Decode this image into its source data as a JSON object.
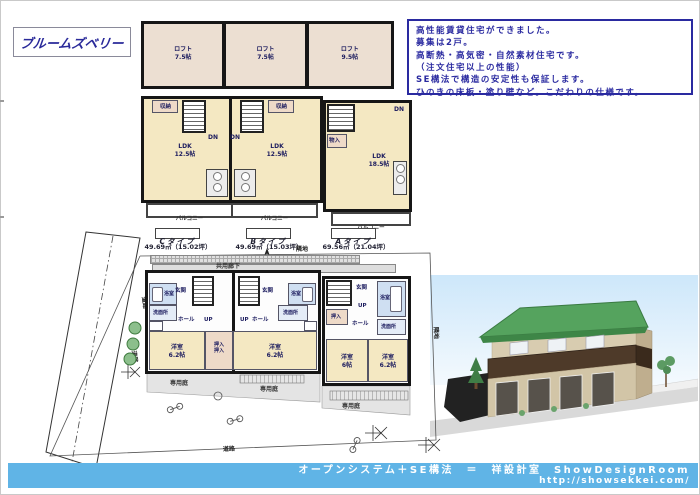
{
  "title": "ブルームズベリー",
  "info_box": {
    "lines": [
      "高性能賃貸住宅ができました。",
      "募集は2戸。",
      "高断熱・高気密・自然素材住宅です。",
      "（注文住宅以上の性能）",
      "SE構法で構造の安定性も保証します。",
      "ひのきの床板・塗り壁など。こだわりの仕様です。"
    ]
  },
  "loft_plan": {
    "room_label": "ロフト",
    "sizes": [
      "7.5帖",
      "7.5帖",
      "9.5帖"
    ]
  },
  "floor2": {
    "ldk": "LDK",
    "ldk_sizes": [
      "12.5帖",
      "12.5帖",
      "18.5帖"
    ],
    "storage": "収納",
    "dn": "DN",
    "closet": "物入",
    "balcony": "バルコニー"
  },
  "unit_types": [
    {
      "label": "Cタイプ",
      "area": "49.69㎡（15.02坪）"
    },
    {
      "label": "Bタイプ",
      "area": "49.69㎡（15.03坪）"
    },
    {
      "label": "Aタイプ",
      "area": "69.56㎡（21.04坪）"
    }
  ],
  "floor1": {
    "corridor": "共用廊下",
    "neighbor": "隣地",
    "road": "道路",
    "garden": "専用庭",
    "bath": "浴室",
    "washroom": "洗面所",
    "entrance": "玄関",
    "hall": "ホール",
    "up": "UP",
    "closet": "押入",
    "room": "洋室",
    "room_sizes": [
      "6.2帖",
      "6.2帖",
      "6帖",
      "6.2帖"
    ]
  },
  "footer": {
    "line1": "オープンシステム＋SE構法　＝　祥設計室　ShowDesignRoom",
    "line2": "http://showsekkei.com/"
  },
  "colors": {
    "footer_bar": "#60b4e6",
    "plan_room_yellow": "#f4e8c2",
    "loft_room_beige": "#ecdfd2",
    "bath_blue": "#cfdff2",
    "closet_pink": "#eedac8",
    "roof_green": "#4e9e58",
    "balcony_brown": "#4e3a29",
    "text_navy": "#2222a0"
  }
}
